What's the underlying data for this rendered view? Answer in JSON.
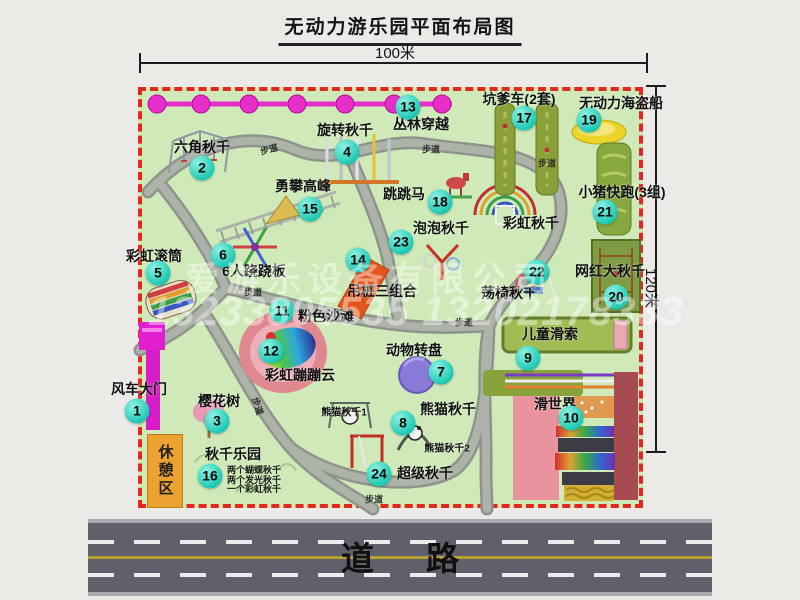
{
  "title": "无动力游乐园平面布局图",
  "dimensions": {
    "width_label": "100米",
    "height_label": "120米"
  },
  "road": {
    "label": "道路"
  },
  "watermark": {
    "company": "爱游乐设备有限公司",
    "phone": "13233805535 13202178333"
  },
  "rest_area": {
    "label": "休憩区"
  },
  "walkway_label": "步道",
  "items": [
    {
      "num": "1",
      "label": "风车大门"
    },
    {
      "num": "2",
      "label": "六角秋千"
    },
    {
      "num": "3",
      "label": "樱花树"
    },
    {
      "num": "4",
      "label": "旋转秋千"
    },
    {
      "num": "5",
      "label": "彩虹滚筒"
    },
    {
      "num": "6",
      "label": "6人跷跷板"
    },
    {
      "num": "7",
      "label": "动物转盘"
    },
    {
      "num": "8",
      "label": "熊猫秋千"
    },
    {
      "num": "9",
      "label": "儿童滑索"
    },
    {
      "num": "10",
      "label": "滑世界"
    },
    {
      "num": "11",
      "label": "粉色沙滩"
    },
    {
      "num": "12",
      "label": "彩虹蹦蹦云"
    },
    {
      "num": "13",
      "label": "丛林穿越"
    },
    {
      "num": "14",
      "label": "吊桩三组合"
    },
    {
      "num": "15",
      "label": "勇攀高峰"
    },
    {
      "num": "16",
      "label": "秋千乐园",
      "notes": [
        "两个蝴蝶秋千",
        "两个发光秋千",
        "一个彩虹秋千"
      ]
    },
    {
      "num": "17",
      "label": "坑爹车(2套)"
    },
    {
      "num": "18",
      "label": "跳跳马"
    },
    {
      "num": "19",
      "label": "无动力海盗船"
    },
    {
      "num": "20",
      "label": "网红大秋千"
    },
    {
      "num": "21",
      "label": "小猪快跑(3组)"
    },
    {
      "num": "22",
      "label": "荡椅秋千"
    },
    {
      "num": "23",
      "label": "泡泡秋千"
    },
    {
      "num": "24",
      "label": "超级秋千"
    }
  ],
  "area_labels": [
    {
      "text": "彩虹秋千"
    },
    {
      "text": "熊猫秋千1"
    },
    {
      "text": "熊猫秋千2"
    }
  ],
  "colors": {
    "map_green": "#cfeab8",
    "border_red": "#e0281c",
    "badge_cyan": "#1fc9b5",
    "zipline_magenta": "#e62ec8",
    "gate_magenta": "#e020d0",
    "rest_orange": "#eba231",
    "road_gray": "#60606a"
  }
}
